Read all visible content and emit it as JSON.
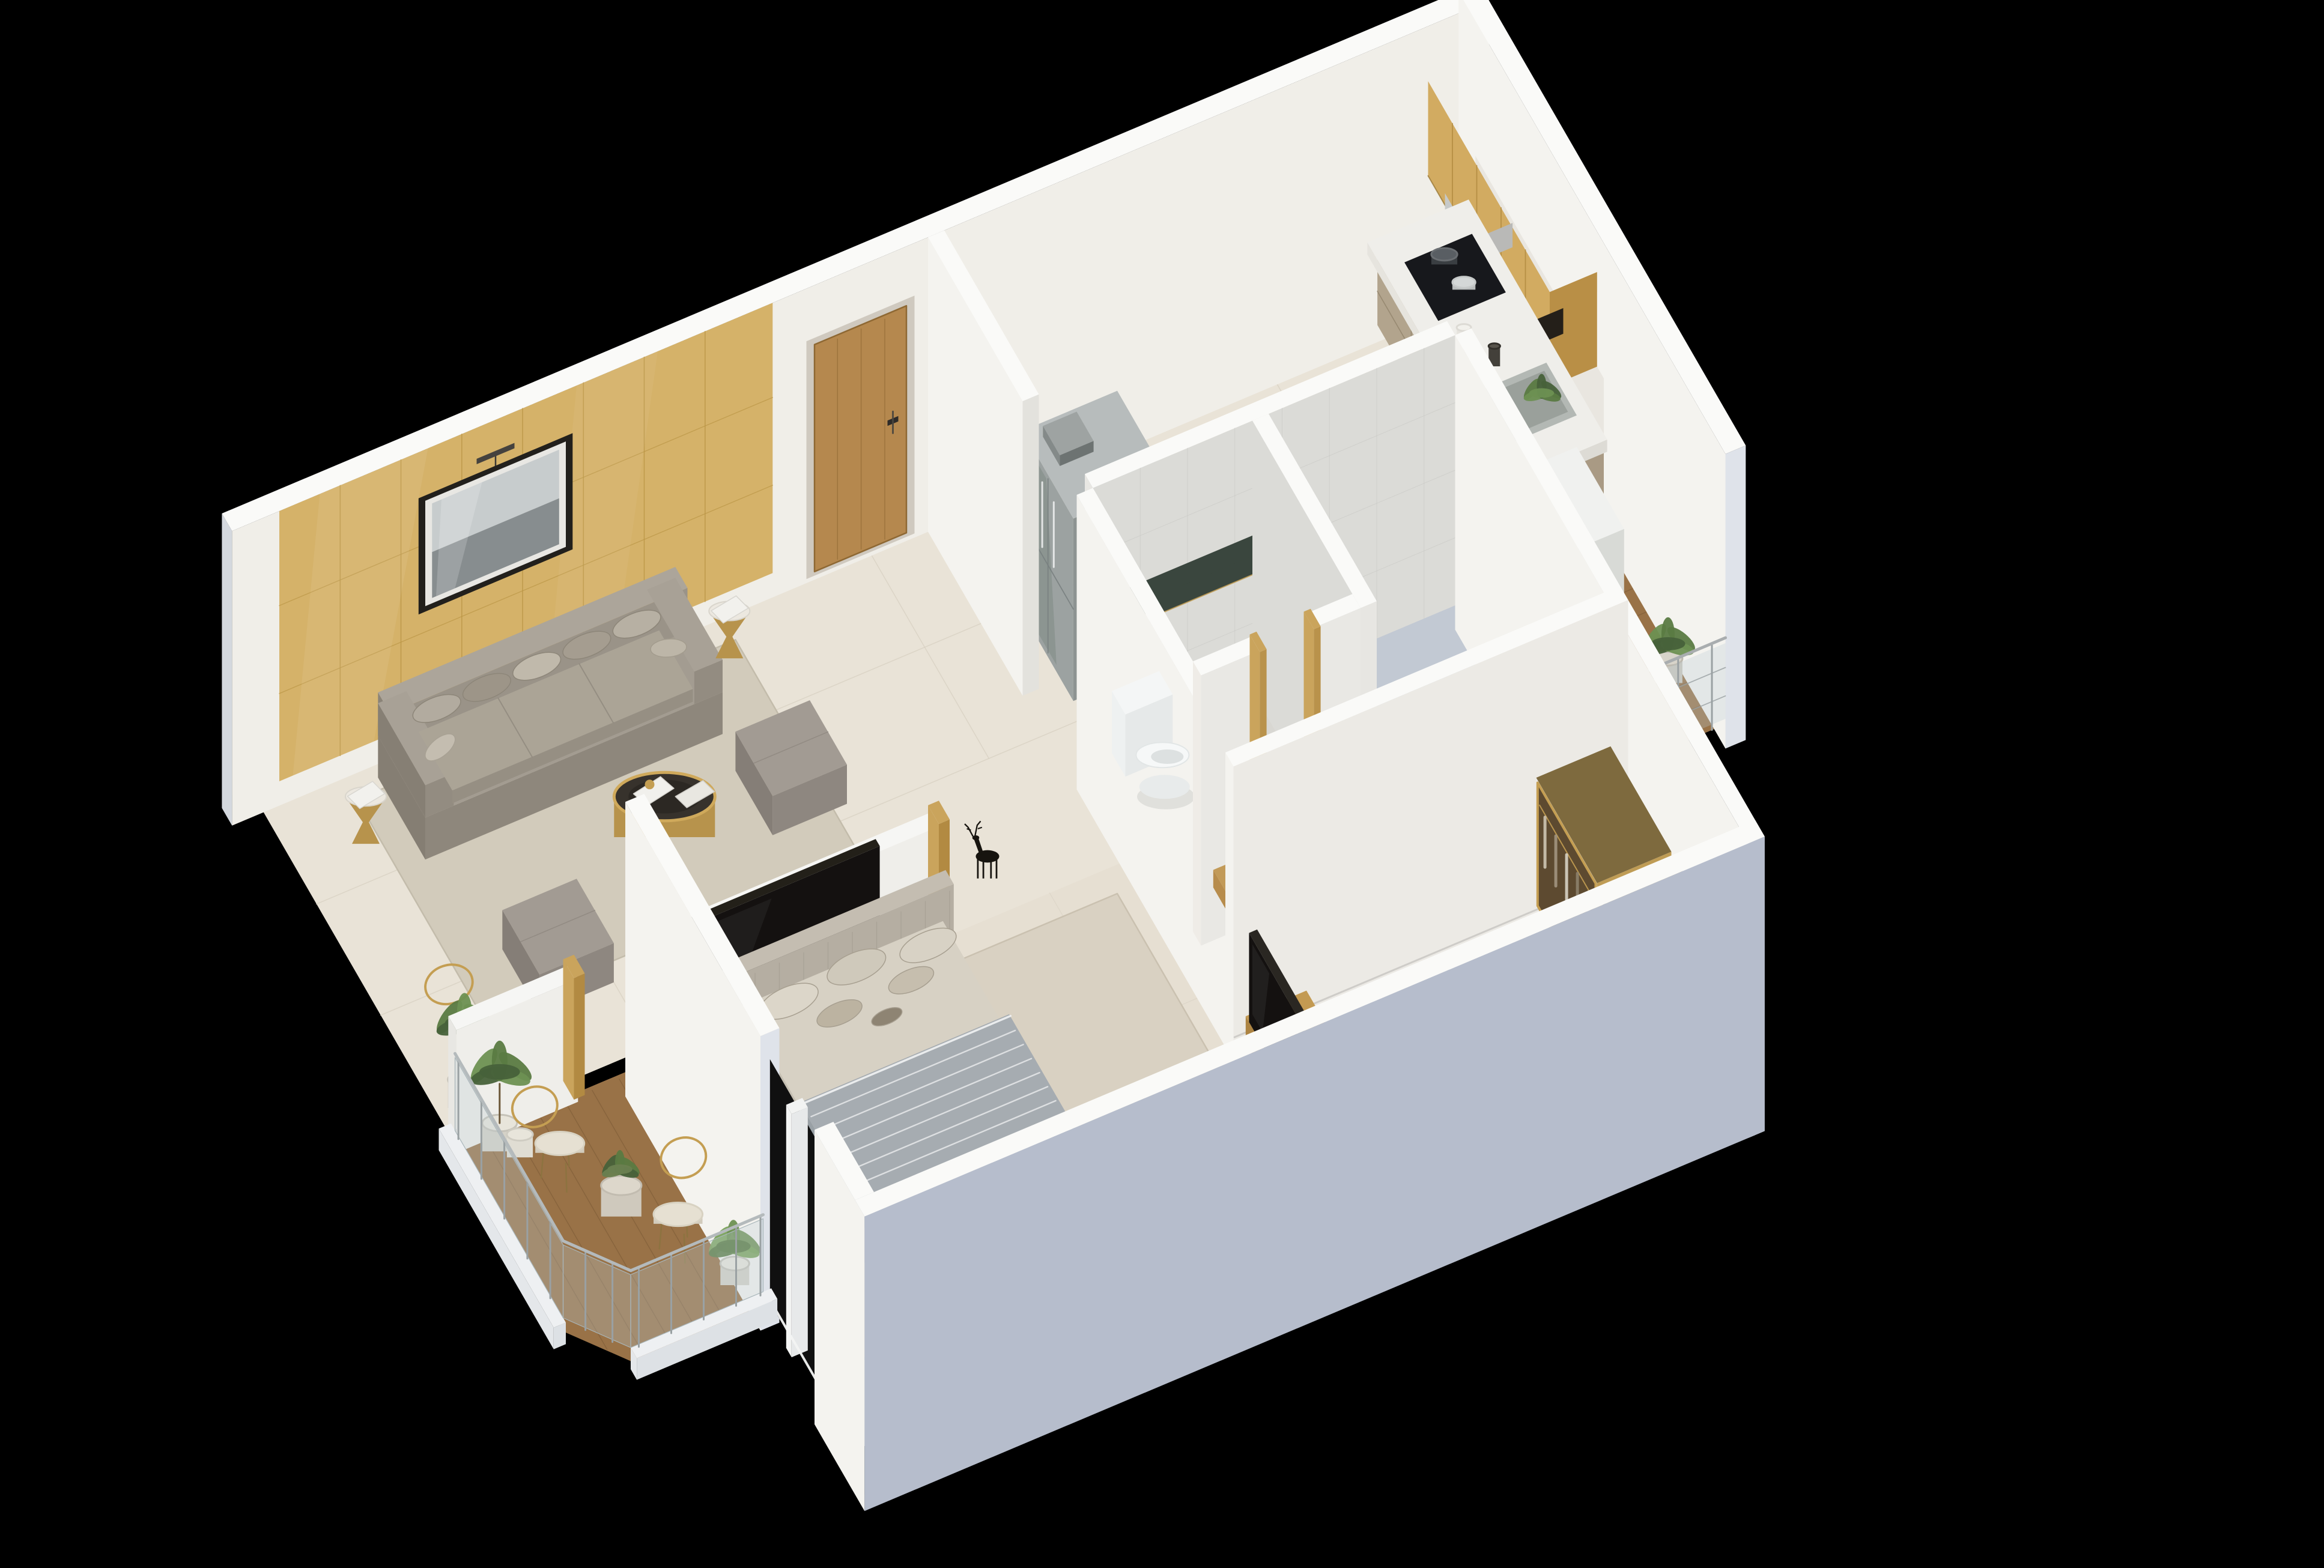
{
  "scene": {
    "title": "3D isometric cutaway floor plan render of a one-bedroom apartment on a black background",
    "background_color": "#000000",
    "projection": "isometric dollhouse cutaway",
    "rooms": [
      {
        "name": "living-room",
        "furniture": [
          "accent-wood-wall",
          "wall-art",
          "sofa",
          "sofa-pillows",
          "side-table",
          "coffee-table",
          "ottoman",
          "area-rug",
          "armchair",
          "side-table-small",
          "floor-plant",
          "deer-figurine",
          "tv-partition-wall",
          "living-room-tv",
          "leaning-frames"
        ]
      },
      {
        "name": "entry",
        "furniture": [
          "entry-door",
          "hall-wall"
        ]
      },
      {
        "name": "kitchen",
        "furniture": [
          "upper-cabinets",
          "bottle-rack",
          "range-hood",
          "kitchen-cabinets",
          "counter-top",
          "stove",
          "cooking-pots",
          "kitchen-sink",
          "sink-plants",
          "refrigerator"
        ]
      },
      {
        "name": "utility-balcony",
        "furniture": [
          "washing-machine",
          "balcony-railing",
          "deck-plants",
          "wood-deck"
        ]
      },
      {
        "name": "bathroom",
        "furniture": [
          "toilet",
          "towel",
          "glass-strip",
          "door-frame",
          "vanity-counter",
          "vessel-sink",
          "shower-glass"
        ]
      },
      {
        "name": "bedroom",
        "furniture": [
          "headboard",
          "bed-mattress",
          "bed-blanket",
          "bed-pillows",
          "nightstand",
          "bed-bench",
          "bedside-table",
          "floor-cushion",
          "picture-frames",
          "accent-rug",
          "window-mullion"
        ]
      },
      {
        "name": "dressing-area",
        "furniture": [
          "wardrobe",
          "deer-sculpture",
          "tv-console",
          "bedroom-tv"
        ]
      },
      {
        "name": "balcony",
        "furniture": [
          "balcony-stub-wall",
          "wire-chair",
          "bistro-stool",
          "potted-plant",
          "olive-plant",
          "monstera-plant",
          "glass-railing",
          "wood-deck"
        ]
      }
    ],
    "palette": {
      "floorCream": "#e9e3d7",
      "floorBedroom": "#e6dfd2",
      "floorSeam": "#d9d2c4",
      "bathFloor": "#d8d7d2",
      "showerFloor": "#c2c9d3",
      "deck": "#997247",
      "deckLine": "#7f5e38",
      "rug": "#d2cbbb",
      "rugEdge": "#c3bcab",
      "rugBedroom": "#d9d1c2",
      "accentRug": "#d6bd8e",
      "wallTop": "#fafaf8",
      "wallFace": "#f0eee8",
      "wallBright": "#f4f3ef",
      "wallShade": "#d4d8de",
      "wallCapBlue": "#dfe3ea",
      "wallOuterBlue": "#b6bdcc",
      "goldWall": "#d5b269",
      "goldLine": "#bb9646",
      "woodDoor": "#b5884e",
      "woodDark": "#8e6833",
      "upperCab": "#d2ab61",
      "cabinetFront": "#b2a48d",
      "counterTop": "#efeeea",
      "steel": "#c6c9c9",
      "tileWall": "#dbdbd7",
      "gold": "#c49e52",
      "sofa": "#9d968c",
      "sofaLight": "#aba496",
      "sofaDark": "#857e73",
      "ottoman": "#a29b93",
      "tableDark": "#37322c",
      "marble": "#ece8e0",
      "tv": "#141110",
      "headboard": "#b5aea2",
      "mattress": "#d7d1c4",
      "blanket": "#a6acb1",
      "blanketStripe": "#e7e9ea",
      "washer": "#e7e8e6",
      "fridge": "#9ca2a1",
      "toilet": "#f6f8f8",
      "plant": "#5a7a42",
      "plantDark": "#47613a",
      "plantLight": "#6d9052",
      "pot": "#e8e5db",
      "railPost": "#9aa1a3",
      "railGlass": "rgba(190,206,212,0.30)",
      "black": "#17140f"
    }
  }
}
